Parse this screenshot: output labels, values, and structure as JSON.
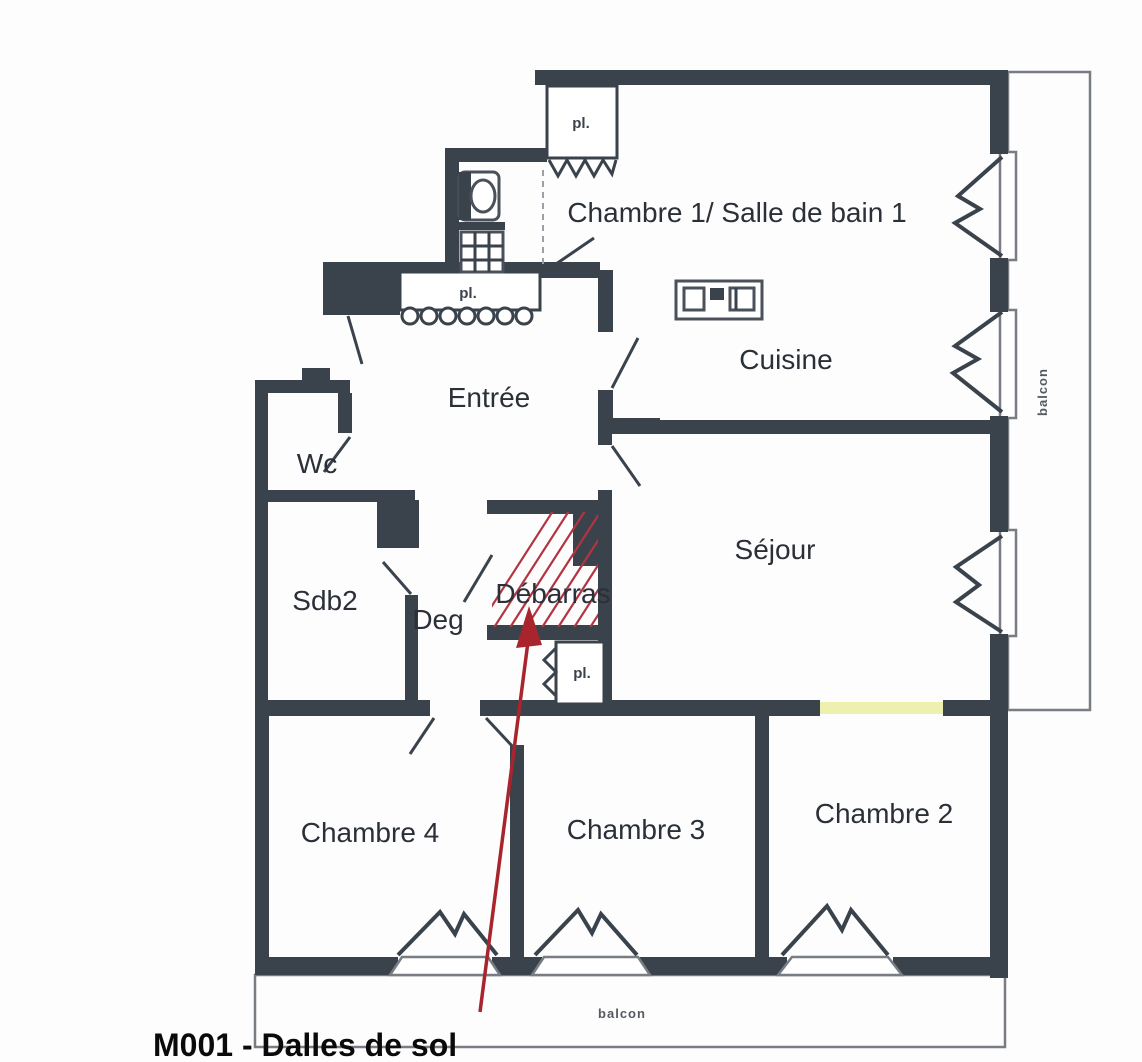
{
  "plan": {
    "caption": "M001 - Dalles de sol",
    "rooms": {
      "chambre1": "Chambre 1/ Salle de bain 1",
      "cuisine": "Cuisine",
      "entree": "Entrée",
      "wc": "Wc",
      "sdb2": "Sdb2",
      "deg": "Deg",
      "debarras": "Débarras",
      "sejour": "Séjour",
      "chambre4": "Chambre 4",
      "chambre3": "Chambre 3",
      "chambre2": "Chambre 2"
    },
    "closets": {
      "chambre1_closet": "pl.",
      "entree_closet": "pl.",
      "debarras_closet": "pl."
    },
    "balconies": {
      "right": "balcon",
      "bottom": "balcon"
    },
    "annotation": {
      "highlighted_room": "Débarras",
      "marker_style": "red diagonal hatching with red arrow from caption"
    },
    "colors": {
      "wall": "#3a424c",
      "balcony_line": "#787d84",
      "highlight_red": "#a8252e",
      "door_yellow": "#eef0b0",
      "label_text": "#2b3038"
    }
  }
}
